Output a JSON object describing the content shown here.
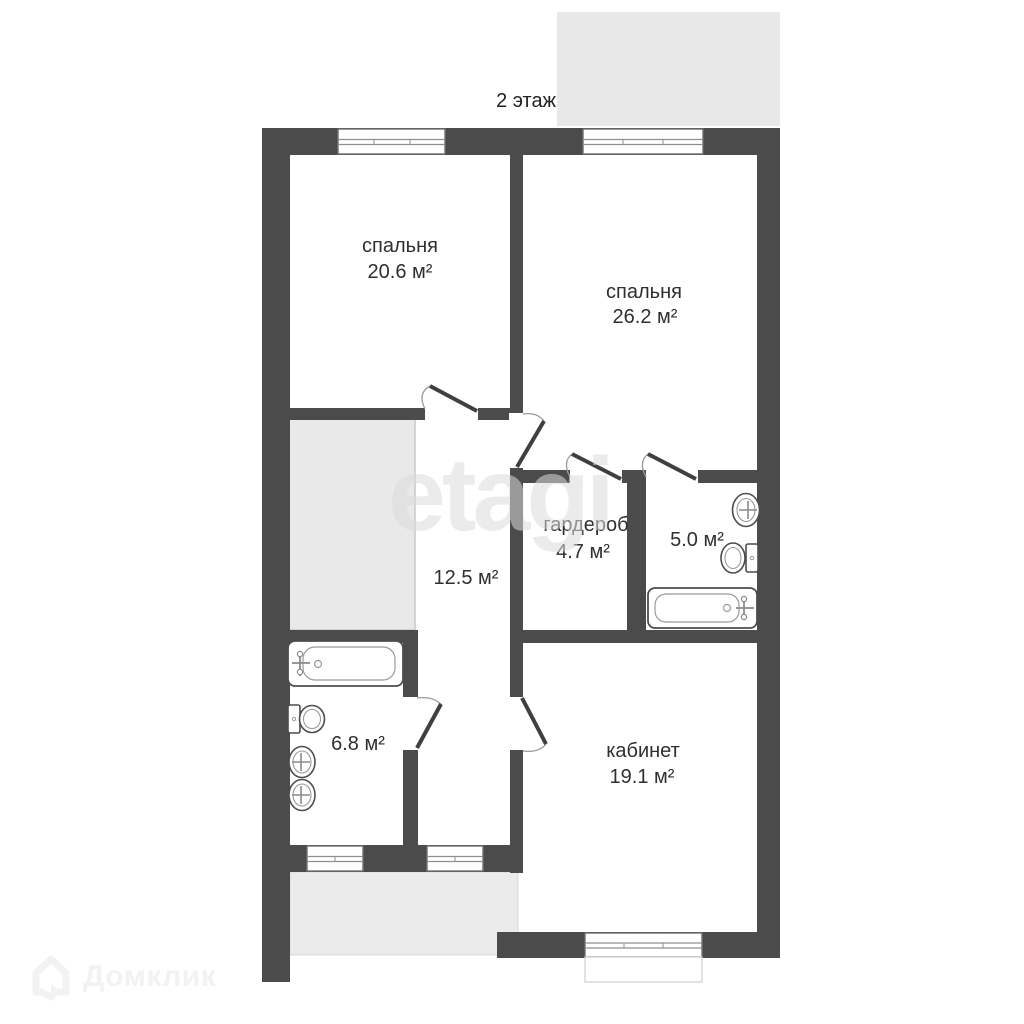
{
  "floor_plan": {
    "floor_label": "2 этаж",
    "rooms": [
      {
        "id": "bedroom-1",
        "name": "спальня",
        "area": "20.6 м²"
      },
      {
        "id": "bedroom-2",
        "name": "спальня",
        "area": "26.2 м²"
      },
      {
        "id": "hallway",
        "name": "",
        "area": "12.5 м²"
      },
      {
        "id": "wardrobe",
        "name": "гардероб",
        "area": "4.7 м²"
      },
      {
        "id": "bathroom-small",
        "name": "",
        "area": "5.0 м²"
      },
      {
        "id": "bathroom-large",
        "name": "",
        "area": "6.8 м²"
      },
      {
        "id": "office",
        "name": "кабинет",
        "area": "19.1 м²"
      }
    ]
  },
  "watermark_text": "etagi",
  "brand_name": "Домклик",
  "icons": {
    "bathtub": "rounded-rect-with-faucet",
    "toilet": "tank-and-bowl-ellipse",
    "sink": "oval-with-faucet-cross",
    "door-swing": "quarter-arc-with-leaf",
    "window": "triple-line-in-wall",
    "brand-house": "house-outline"
  },
  "colors": {
    "wall": "#4b4b4b",
    "floor": "#ffffff",
    "shaded_area": "#e9e9e9",
    "label_text": "#2f2f2f",
    "watermark": "#dcdcdc",
    "brand": "#f2f2f2"
  }
}
